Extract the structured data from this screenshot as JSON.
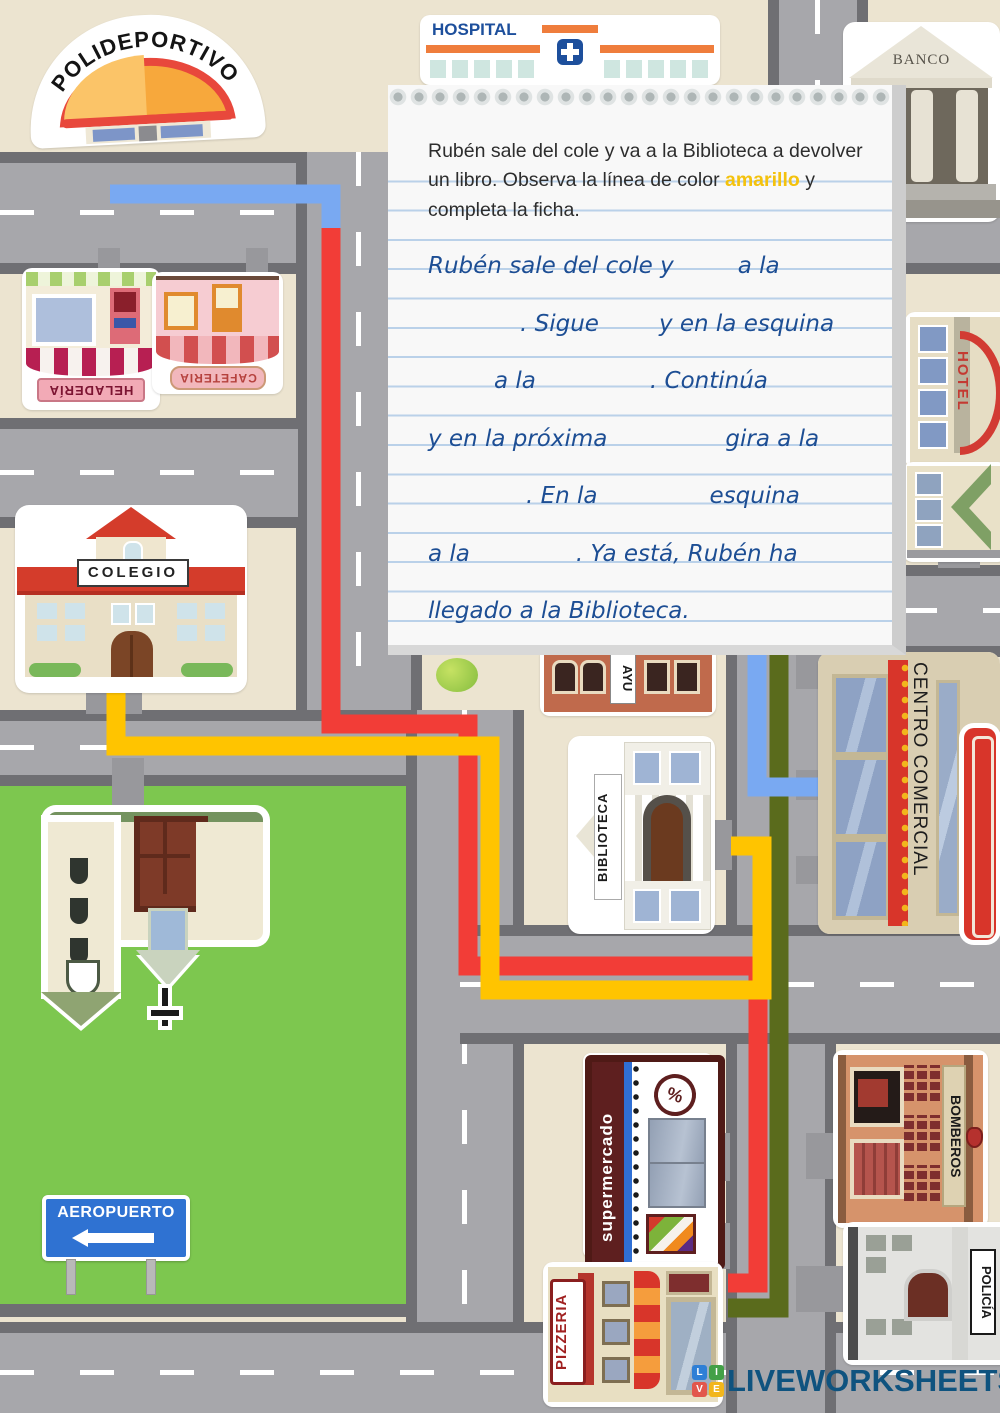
{
  "worksheet": {
    "note": {
      "intro": {
        "before": "Rubén sale del cole y va a la Biblioteca a devolver un libro. Observa la línea de color ",
        "highlight": "amarillo",
        "after": " y completa la ficha.",
        "highlight_color": "#f4c20d"
      },
      "lines": [
        {
          "segments": [
            {
              "text": "Rubén sale del cole y"
            },
            {
              "gap": 64
            },
            {
              "text": "a la"
            }
          ]
        },
        {
          "segments": [
            {
              "gap": 92
            },
            {
              "text": ". Sigue"
            },
            {
              "gap": 60
            },
            {
              "text": "y en la esquina"
            }
          ]
        },
        {
          "segments": [
            {
              "gap": 66
            },
            {
              "text": "a la"
            },
            {
              "gap": 114
            },
            {
              "text": ". Continúa"
            }
          ]
        },
        {
          "segments": [
            {
              "text": "y en la próxima"
            },
            {
              "gap": 118
            },
            {
              "text": "gira a la"
            }
          ]
        },
        {
          "segments": [
            {
              "gap": 98
            },
            {
              "text": ". En la"
            },
            {
              "gap": 112
            },
            {
              "text": "esquina"
            }
          ]
        },
        {
          "segments": [
            {
              "text": "a la"
            },
            {
              "gap": 106
            },
            {
              "text": ". Ya está, Rubén ha"
            }
          ]
        },
        {
          "segments": [
            {
              "text": "llegado a la Biblioteca."
            }
          ]
        }
      ]
    }
  },
  "map": {
    "buildings": {
      "polideportivo": {
        "label": "POLIDEPORTIVO"
      },
      "hospital": {
        "label": "HOSPITAL"
      },
      "banco": {
        "label": "BANCO"
      },
      "heladeria": {
        "label": "HELADERÍA"
      },
      "cafeteria": {
        "label": "CAFETERIA"
      },
      "hotel": {
        "label": "HOTEL"
      },
      "colegio": {
        "label": "COLEGIO"
      },
      "ayuntamiento": {
        "label": "AYU"
      },
      "biblioteca": {
        "label": "BIBLIOTECA"
      },
      "centro_comercial": {
        "label": "CENTRO COMERCIAL"
      },
      "supermercado": {
        "label": "supermercado"
      },
      "bomberos": {
        "label": "BOMBEROS"
      },
      "policia": {
        "label": "POLICÍA"
      },
      "pizzeria": {
        "label": "PIZZERIA"
      },
      "aeropuerto": {
        "label": "AEROPUERTO"
      },
      "supermercado_badge": {
        "label": "%"
      }
    },
    "routes": {
      "yellow": {
        "color": "#ffc400"
      },
      "red": {
        "color": "#f23d37"
      },
      "blue": {
        "color": "#79a9f2"
      },
      "olive": {
        "color": "#5a6b1c"
      }
    }
  },
  "footer": {
    "brand": "LIVEWORKSHEETS",
    "logo_letters": [
      "L",
      "I",
      "V",
      "E"
    ],
    "logo_colors": [
      "#2f7fd6",
      "#43a047",
      "#e2574c",
      "#f2b61c"
    ]
  }
}
